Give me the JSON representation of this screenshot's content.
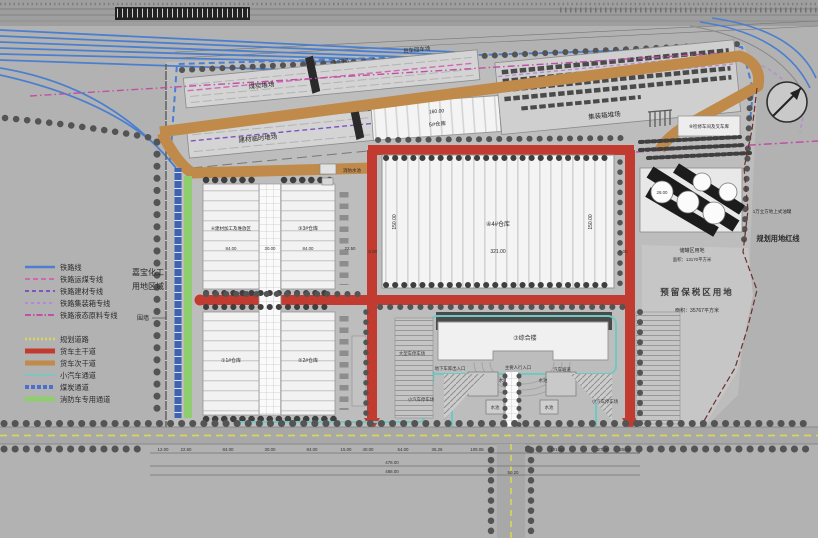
{
  "legend": {
    "rail": [
      {
        "label": "铁路线",
        "color": "#4a7fd0"
      },
      {
        "label": "铁路运煤专线",
        "color": "#cf6ab2"
      },
      {
        "label": "铁路建材专线",
        "color": "#7d55c0"
      },
      {
        "label": "铁路集装箱专线",
        "color": "#b48ad2"
      },
      {
        "label": "铁路液态原料专线",
        "color": "#c04fa6"
      }
    ],
    "road": [
      {
        "label": "规划道路",
        "color": "#d8d855"
      },
      {
        "label": "货车主干道",
        "color": "#c23b30"
      },
      {
        "label": "货车次干道",
        "color": "#bf8a4a"
      },
      {
        "label": "小汽车通道",
        "color": "#6fc9c3"
      },
      {
        "label": "煤炭通道",
        "color": "#4a6fd0"
      },
      {
        "label": "消防车专用通道",
        "color": "#8fce6f"
      }
    ]
  },
  "site": {
    "owner1": "嘉宝化工",
    "owner2": "用地区域",
    "fence": "围墙"
  },
  "yards": {
    "coal": "煤炭堆场",
    "material": "建材临时堆场",
    "container": "集装箱堆场",
    "truck_return": "货车回车场",
    "gantry1": "1#门吊",
    "gantry2": "2#门吊"
  },
  "buildings": {
    "w1": "①1#仓库",
    "w2": "②2#仓库",
    "w3": "③3#仓库",
    "w4": "④4#仓库",
    "w5": "5#仓库",
    "processing": "⑥建材加工及堆放区",
    "complex": "⑦综合楼",
    "workshop": "⑧检修车间及叉车库",
    "fire_pool": "消防水池"
  },
  "tank": {
    "label": "1万立方地上式油罐",
    "dim": "28.00",
    "zone": "储罐区用地",
    "zone_area": "面积：13170平方米"
  },
  "reserved": {
    "label": "预留保税区用地",
    "area": "面积：35767平方米",
    "red_line": "规划用地红线"
  },
  "plaza": {
    "large_parking": "大型车停车场",
    "garage": "地下车库出入口",
    "pedestrian": "主要人行入口",
    "ramp": "汽车坡道",
    "pool1": "水池",
    "pool2": "水池",
    "pool3": "水池",
    "pool4": "水池",
    "parking_left": "小汽车停车场",
    "parking_right": "小汽车停车场"
  },
  "dims": {
    "w4_width": "321.00",
    "w4_left": "150.00",
    "w4_right": "150.00",
    "w4_side_l": "6.00",
    "w4_side_r": "6.00",
    "w5_len": "160.00",
    "row": [
      "84.00",
      "30.00",
      "84.00",
      "22.50"
    ],
    "chain": [
      "12.00",
      "22.60",
      "84.00",
      "30.00",
      "84.00",
      "15.00",
      "40.00",
      "54.00",
      "36.26",
      "109.06"
    ],
    "right_chain": [
      "101.18",
      "27.00",
      "25.00"
    ],
    "total1": "478.00",
    "total2": "488.00",
    "vroad": "50.20"
  },
  "colors": {
    "rail_blue": "#4a7fd0",
    "coal_rail_pink": "#cf6ab2",
    "material_purple": "#7d55c0",
    "container_purple": "#b48ad2",
    "liquid_magenta": "#c04fa6",
    "plan_road_yellow": "#d8d855",
    "truck_main_red": "#c23b30",
    "truck_secondary_orange": "#bf8a4a",
    "car_cyan": "#6fc9c3",
    "coal_corridor_blue": "#4a6fd0",
    "fire_green": "#8fce6f"
  }
}
